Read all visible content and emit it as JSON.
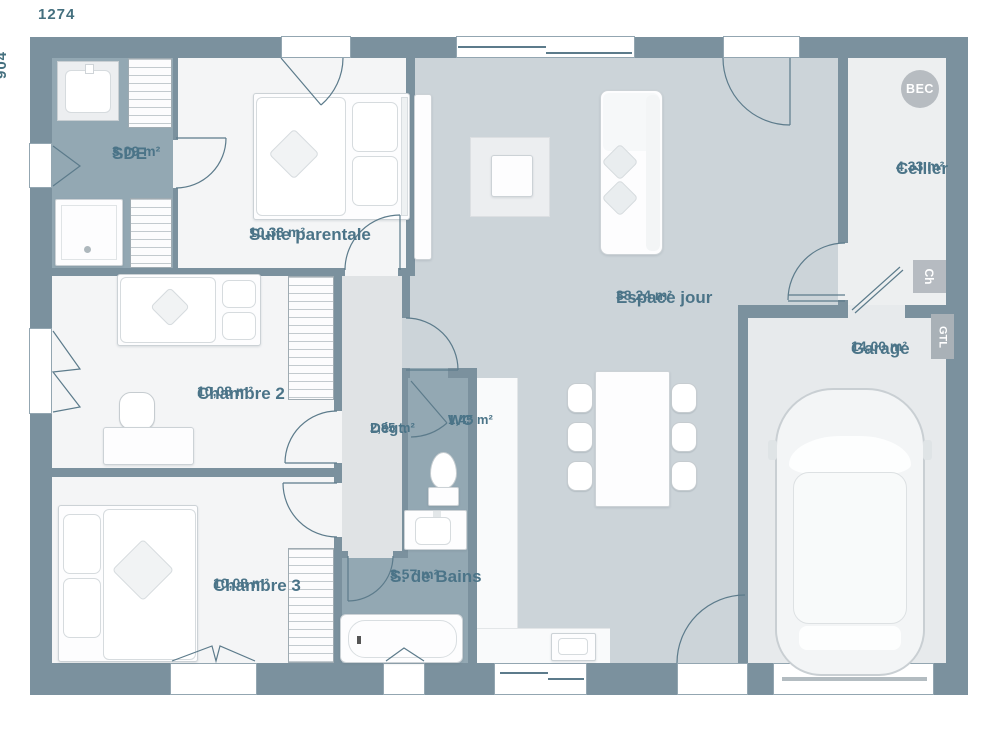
{
  "plan": {
    "dimensions": {
      "width": "1274",
      "height": "904"
    },
    "rooms": [
      {
        "name": "SDE",
        "area": "3,09 m²"
      },
      {
        "name": "Suite parentale",
        "area": "10,38 m²"
      },
      {
        "name": "Chambre 2",
        "area": "10,08 m²"
      },
      {
        "name": "Chambre 3",
        "area": "10,08 m²"
      },
      {
        "name": "Dégt.",
        "area": "2,85 m²"
      },
      {
        "name": "WC",
        "area": "1,45 m²"
      },
      {
        "name": "S. de Bains",
        "area": "3,57 m²"
      },
      {
        "name": "Espace jour",
        "area": "38,24 m²"
      },
      {
        "name": "Cellier",
        "area": "4,33 m²"
      },
      {
        "name": "Garage",
        "area": "14,00 m²"
      }
    ],
    "annotations": {
      "bec": "BEC",
      "ch": "Ch",
      "gtl": "GTL"
    },
    "furniture_icons": [
      "double-bed",
      "single-bed",
      "desk",
      "office-chair",
      "wardrobe",
      "washbasin",
      "shower",
      "toilet",
      "bathtub",
      "vanity-sink",
      "sofa",
      "coffee-table",
      "dining-table",
      "dining-chair",
      "kitchen-counter",
      "kitchen-sink",
      "sideboard",
      "car"
    ],
    "colors": {
      "wall": "#7b919e",
      "wet": "#93a8b3",
      "living": "#ccd4d9",
      "hall": "#e0e3e5",
      "bedroom": "#f4f5f6",
      "cellier": "#edeff0",
      "garage": "#e7eaec",
      "label": "#4b7488",
      "annot": "#b7bcc1"
    }
  }
}
